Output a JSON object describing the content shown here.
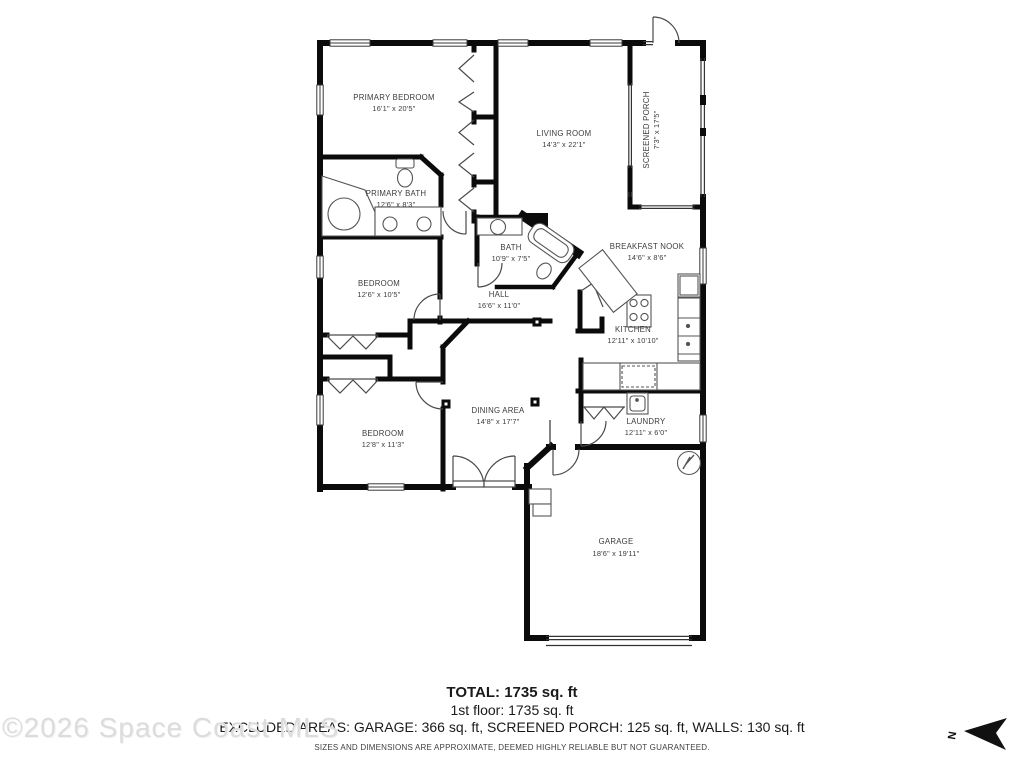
{
  "floorplan": {
    "rooms": [
      {
        "name": "PRIMARY BEDROOM",
        "dims": "16'1\" x 20'5\""
      },
      {
        "name": "LIVING ROOM",
        "dims": "14'3\" x 22'1\""
      },
      {
        "name": "SCREENED PORCH",
        "dims": "7'3\" x 17'5\""
      },
      {
        "name": "PRIMARY BATH",
        "dims": "12'6\" x 8'3\""
      },
      {
        "name": "BATH",
        "dims": "10'9\" x 7'5\""
      },
      {
        "name": "BREAKFAST NOOK",
        "dims": "14'6\" x 8'6\""
      },
      {
        "name": "BEDROOM",
        "dims": "12'6\" x 10'5\""
      },
      {
        "name": "HALL",
        "dims": "16'6\" x 11'0\""
      },
      {
        "name": "KITCHEN",
        "dims": "12'11\" x 10'10\""
      },
      {
        "name": "DINING AREA",
        "dims": "14'8\" x 17'7\""
      },
      {
        "name": "BEDROOM",
        "dims": "12'8\" x 11'3\""
      },
      {
        "name": "LAUNDRY",
        "dims": "12'11\" x 6'0\""
      },
      {
        "name": "GARAGE",
        "dims": "18'6\" x 19'11\""
      }
    ]
  },
  "summary": {
    "total": "TOTAL: 1735 sq. ft",
    "first_floor": "1st floor: 1735 sq. ft",
    "excluded": "EXCLUDED AREAS: GARAGE: 366 sq. ft, SCREENED PORCH: 125 sq. ft, WALLS: 130 sq. ft",
    "disclaimer": "SIZES AND DIMENSIONS ARE APPROXIMATE, DEEMED HIGHLY RELIABLE BUT NOT GUARANTEED."
  },
  "watermark": "©2026 Space Coast MLS",
  "compass": {
    "label": "N"
  }
}
